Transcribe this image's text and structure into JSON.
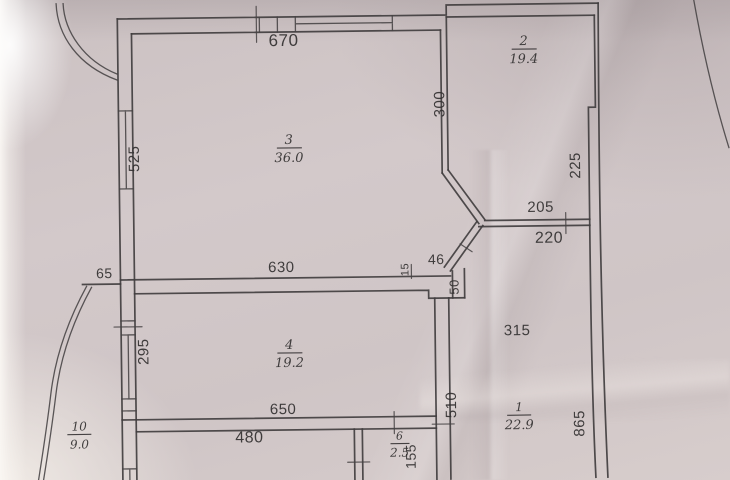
{
  "plan": {
    "rooms": [
      {
        "number": "3",
        "area": "36.0"
      },
      {
        "number": "2",
        "area": "19.4"
      },
      {
        "number": "4",
        "area": "19.2"
      },
      {
        "number": "1",
        "area": "22.9"
      },
      {
        "number": "6",
        "area": "2.5"
      },
      {
        "number": "10",
        "area": "9.0"
      }
    ],
    "dims": {
      "d670": "670",
      "d630": "630",
      "d650": "650",
      "d480": "480",
      "d525": "525",
      "d300": "300",
      "d225": "225",
      "d295": "295",
      "d205": "205",
      "d220": "220",
      "d315": "315",
      "d510": "510",
      "d155": "155",
      "d865": "865",
      "d46": "46",
      "d50": "50",
      "d65": "65",
      "d15": "15"
    },
    "colors": {
      "ink": "#413e3f",
      "paper": "#cfc5c6"
    }
  }
}
